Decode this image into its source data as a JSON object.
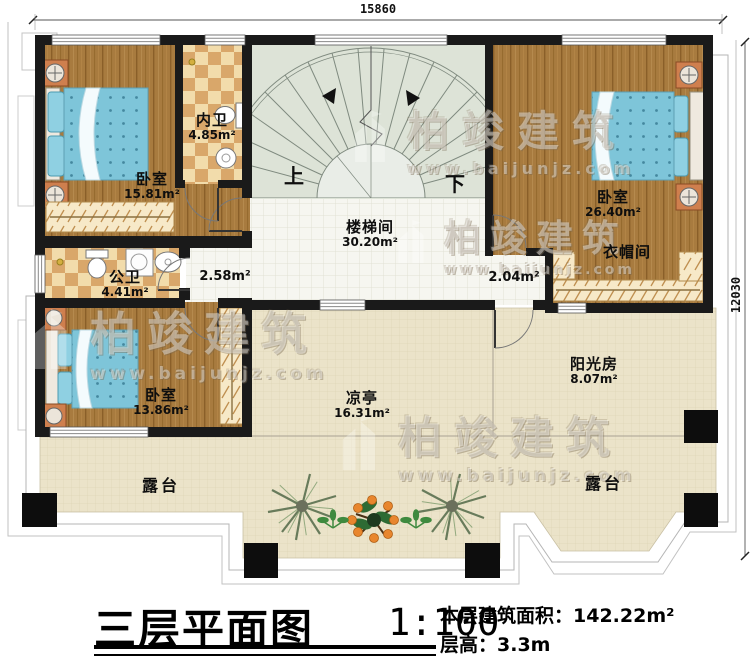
{
  "dimensions": {
    "top_width": "15860",
    "right_height": "12030"
  },
  "watermark": {
    "brand": "柏竣建筑",
    "url": "www.baijunjz.com"
  },
  "stairwell_markers": {
    "up": "上",
    "down": "下"
  },
  "rooms": {
    "bedroom_top_left": {
      "name": "卧室",
      "area": "15.81m²"
    },
    "ensuite_bathroom": {
      "name": "内卫",
      "area": "4.85m²"
    },
    "stairwell": {
      "name": "楼梯间",
      "area": "30.20m²"
    },
    "bedroom_top_right": {
      "name": "卧室",
      "area": "26.40m²"
    },
    "cloakroom": {
      "name": "衣帽间"
    },
    "public_bathroom": {
      "name": "公卫",
      "area": "4.41m²"
    },
    "corridor": {
      "area": "2.58m²"
    },
    "vestibule": {
      "area": "2.04m²"
    },
    "bedroom_bottom_left": {
      "name": "卧室",
      "area": "13.86m²"
    },
    "pavilion": {
      "name": "凉亭",
      "area": "16.31m²"
    },
    "sunroom": {
      "name": "阳光房",
      "area": "8.07m²"
    },
    "terrace_left": {
      "name": "露台"
    },
    "terrace_right": {
      "name": "露台"
    }
  },
  "title_block": {
    "title": "三层平面图",
    "scale": "1:100",
    "area_label": "本层建筑面积：",
    "area_value": "142.22m²",
    "floor_height_label": "层高：",
    "floor_height_value": "3.3m"
  },
  "colors": {
    "wall": "#1a1a1a",
    "wood_floor": "#a87b3f",
    "bath_tile": "#d9a76a",
    "stair_floor": "#dde3d7",
    "terrace_floor": "#ebe3c9",
    "bed": "#7ec5d9",
    "nightstand": "#cf7f4e",
    "watermark": "#c8b894"
  }
}
